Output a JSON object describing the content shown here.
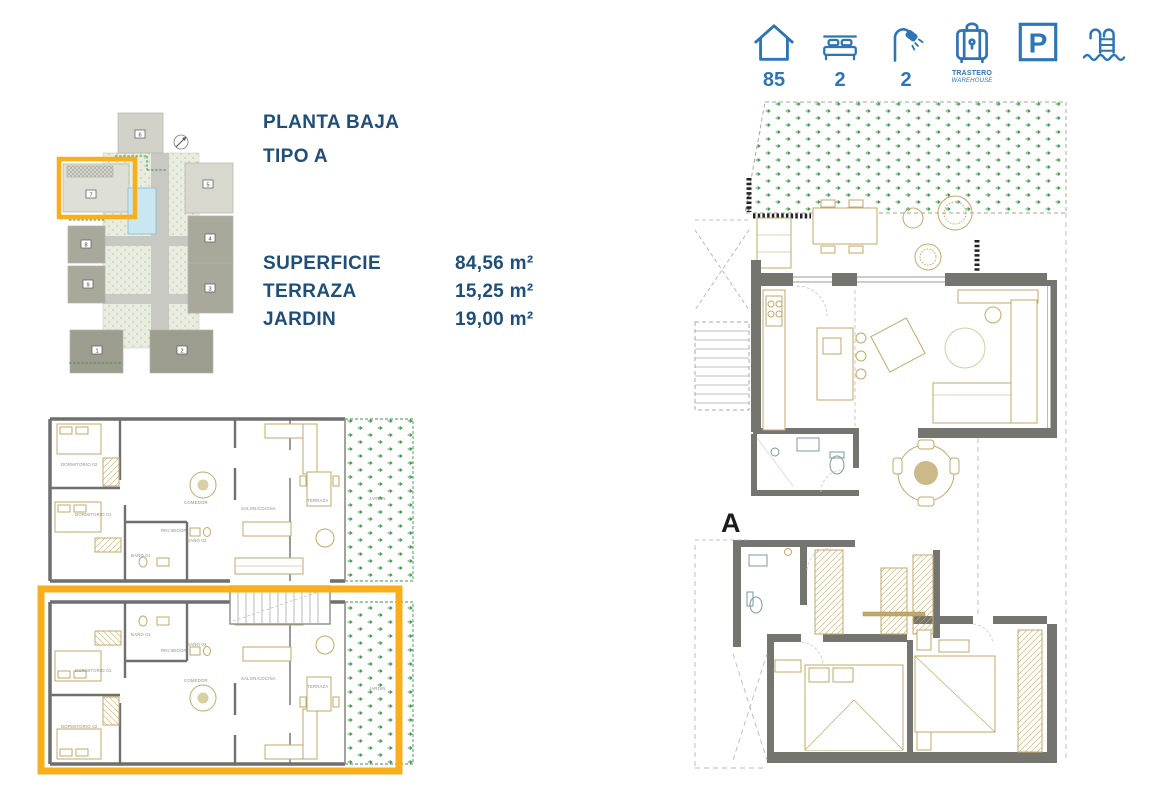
{
  "colors": {
    "accent_blue": "#2E75B6",
    "navy_text": "#1F4E79",
    "highlight_orange": "#F9AF1C",
    "wall_gray": "#757570",
    "furniture_tan": "#C2A86B",
    "garden_green": "#3D9448",
    "pool_blue": "#C9E7F0"
  },
  "stats": {
    "area": {
      "icon": "house-icon",
      "value": "85"
    },
    "bedrooms": {
      "icon": "bed-icon",
      "value": "2"
    },
    "bathrooms": {
      "icon": "shower-icon",
      "value": "2"
    },
    "storage": {
      "icon": "warehouse-icon",
      "line1": "TRASTERO",
      "line2": "WAREHOUSE"
    },
    "parking": {
      "icon": "parking-icon",
      "letter": "P"
    },
    "pool": {
      "icon": "pool-icon"
    }
  },
  "info": {
    "title_line1": "PLANTA BAJA",
    "title_line2": "TIPO A",
    "specs": [
      {
        "label": "SUPERFICIE",
        "value": "84,56 m²"
      },
      {
        "label": "TERRAZA",
        "value": "15,25 m²"
      },
      {
        "label": "JARDIN",
        "value": "19,00 m²"
      }
    ]
  },
  "site_plan": {
    "blocks": [
      "1",
      "2",
      "3",
      "4",
      "5",
      "6",
      "7",
      "8",
      "9"
    ],
    "highlighted_block": "7"
  },
  "overview_plan": {
    "labels_top": [
      "DORMITORIO 02",
      "DORMITORIO 01",
      "BAÑO 01",
      "RECIBIDOR",
      "BAÑO 02",
      "COMEDOR",
      "SALON/COCINA",
      "TERRAZA",
      "JARDIN"
    ],
    "labels_bottom": [
      "BAÑO 01",
      "RECIBIDOR",
      "BAÑO 02",
      "DORMITORIO 01",
      "COMEDOR",
      "SALON/COCINA",
      "TERRAZA",
      "JARDIN",
      "DORMITORIO 02"
    ]
  },
  "main_plan": {
    "section_label": "A"
  }
}
